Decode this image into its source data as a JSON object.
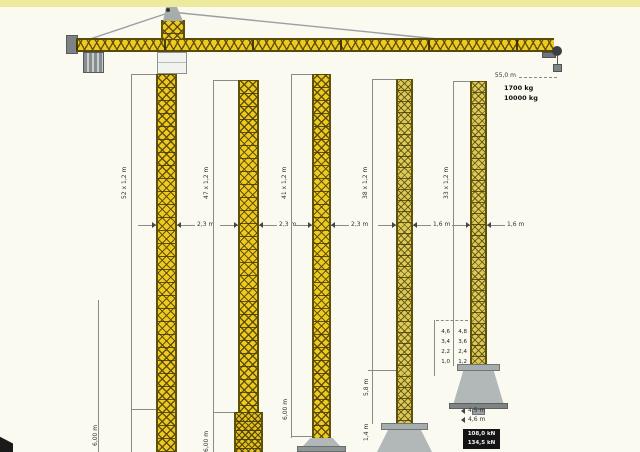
{
  "diagram": {
    "type": "tower-crane-elevation-with-tower-systems",
    "jib": {
      "length_label": "55,0 m",
      "tip_load_label": "1700 kg",
      "max_load_label": "10000 kg"
    },
    "towers": [
      {
        "name": "tower-1",
        "height_label": "52 x 1,2 m",
        "width_label": "2,3 m",
        "base_label": "6,00 m"
      },
      {
        "name": "tower-2",
        "height_label": "47 x 1,2 m",
        "width_label": "2,3 m",
        "base_label": "6,00 m"
      },
      {
        "name": "tower-3",
        "height_label": "41 x 1,2 m",
        "width_label": "2,3 m",
        "base_label": "6,00 m"
      },
      {
        "name": "tower-4",
        "height_label": "38 x 1,2 m",
        "width_label": "1,6 m",
        "upper_base_label": "5,8 m",
        "lower_base_label": "1,4 m"
      },
      {
        "name": "tower-5",
        "height_label": "33 x 1,2 m",
        "width_label": "1,6 m",
        "section_table": {
          "rows": [
            [
              "4,6",
              "4,8"
            ],
            [
              "3,4",
              "3,6"
            ],
            [
              "2,2",
              "2,4"
            ],
            [
              "1,0",
              "1,2"
            ]
          ]
        },
        "base_width_label_1": "4,5 m",
        "base_width_label_2": "4,6 m",
        "badge_line_1": "108,0 kN",
        "badge_line_2": "134,5 kN"
      }
    ],
    "colors": {
      "crane_yellow": "#eec91e",
      "lattice_dark": "#5f5207",
      "steel_gray": "#a7acac",
      "accent_strip": "#edea9d",
      "badge_black": "#141414"
    }
  }
}
